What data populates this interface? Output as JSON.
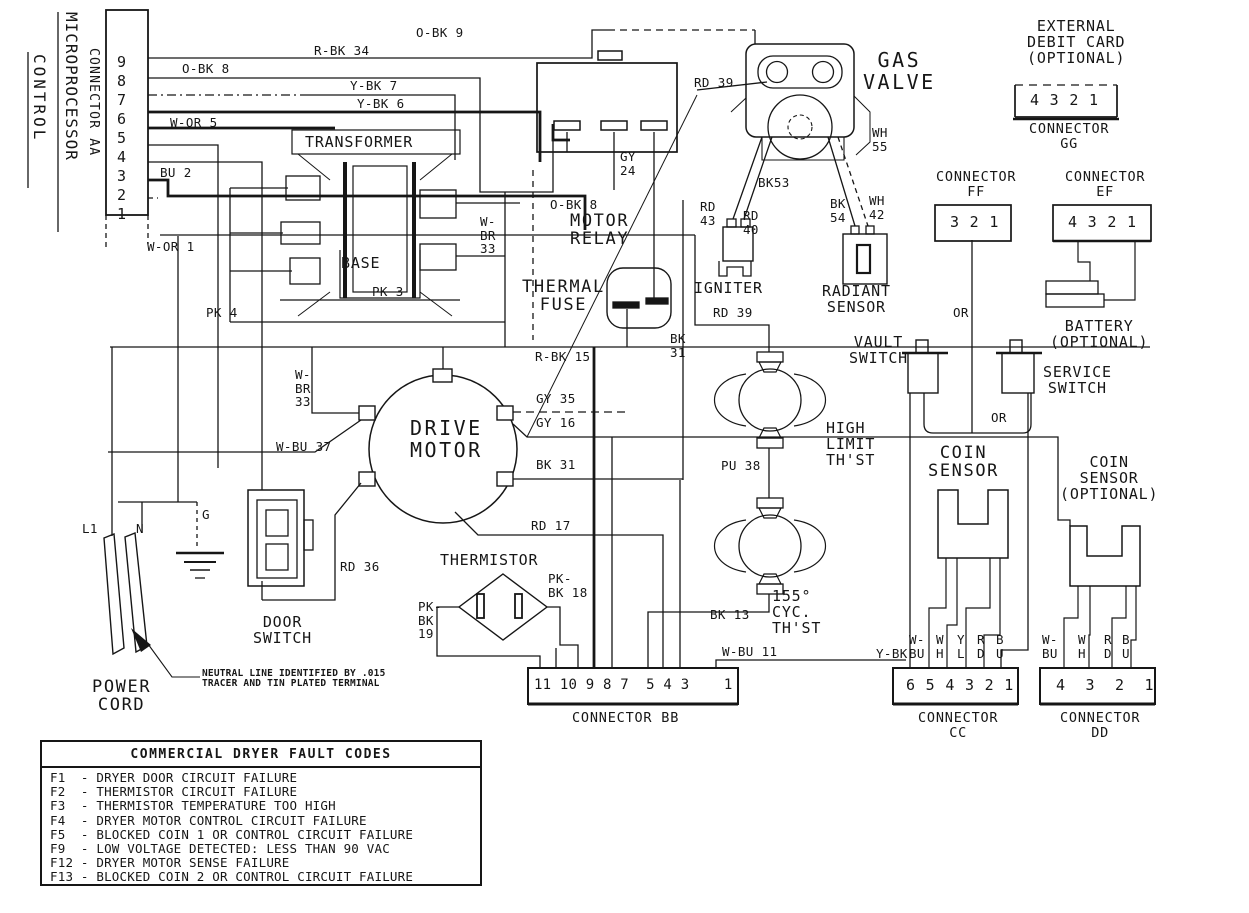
{
  "page": {
    "background": "#ffffff",
    "ink": "#161616"
  },
  "vertical_headers": {
    "microprocessor": "MICROPROCESSOR",
    "control": "CONTROL",
    "connector_aa": "CONNECTOR AA"
  },
  "note": "NEUTRAL LINE IDENTIFIED BY .015\nTRACER AND TIN PLATED TERMINAL",
  "labels": [
    {
      "n": "aa-pin-9",
      "t": "9",
      "x": 117,
      "y": 54,
      "c": "m"
    },
    {
      "n": "aa-pin-8",
      "t": "8",
      "x": 117,
      "y": 73,
      "c": "m"
    },
    {
      "n": "aa-pin-7",
      "t": "7",
      "x": 117,
      "y": 92,
      "c": "m"
    },
    {
      "n": "aa-pin-6",
      "t": "6",
      "x": 117,
      "y": 111,
      "c": "m"
    },
    {
      "n": "aa-pin-5",
      "t": "5",
      "x": 117,
      "y": 130,
      "c": "m"
    },
    {
      "n": "aa-pin-4",
      "t": "4",
      "x": 117,
      "y": 149,
      "c": "m"
    },
    {
      "n": "aa-pin-3",
      "t": "3",
      "x": 117,
      "y": 168,
      "c": "m"
    },
    {
      "n": "aa-pin-2",
      "t": "2",
      "x": 117,
      "y": 187,
      "c": "m"
    },
    {
      "n": "aa-pin-1",
      "t": "1",
      "x": 117,
      "y": 206,
      "c": "m"
    },
    {
      "n": "wire-o-bk-8-top",
      "t": "O-BK 8",
      "x": 182,
      "y": 62,
      "c": "s"
    },
    {
      "n": "wire-r-bk-34",
      "t": "R-BK 34",
      "x": 314,
      "y": 44,
      "c": "s"
    },
    {
      "n": "wire-o-bk-9",
      "t": "O-BK 9",
      "x": 416,
      "y": 26,
      "c": "s"
    },
    {
      "n": "wire-y-bk-7",
      "t": "Y-BK 7",
      "x": 350,
      "y": 79,
      "c": "s"
    },
    {
      "n": "wire-y-bk-6",
      "t": "Y-BK 6",
      "x": 357,
      "y": 97,
      "c": "s"
    },
    {
      "n": "wire-w-or-5",
      "t": "W-OR 5",
      "x": 170,
      "y": 116,
      "c": "s"
    },
    {
      "n": "wire-bu-2",
      "t": "BU 2",
      "x": 160,
      "y": 166,
      "c": "s"
    },
    {
      "n": "wire-w-or-1",
      "t": "W-OR 1",
      "x": 147,
      "y": 240,
      "c": "s"
    },
    {
      "n": "wire-pk-4",
      "t": "PK 4",
      "x": 206,
      "y": 306,
      "c": "s"
    },
    {
      "n": "wire-pk-3",
      "t": "PK 3",
      "x": 372,
      "y": 285,
      "c": "s"
    },
    {
      "n": "wire-w-br-33-upper",
      "t": "W-\nBR\n33",
      "x": 480,
      "y": 215,
      "c": "s"
    },
    {
      "n": "wire-gy-24",
      "t": "GY\n24",
      "x": 620,
      "y": 150,
      "c": "s"
    },
    {
      "n": "wire-o-bk-8-relay",
      "t": "O-BK 8",
      "x": 550,
      "y": 198,
      "c": "s"
    },
    {
      "n": "wire-rd-39-top",
      "t": "RD 39",
      "x": 694,
      "y": 76,
      "c": "s"
    },
    {
      "n": "wire-wh-55",
      "t": "WH\n55",
      "x": 872,
      "y": 126,
      "c": "s"
    },
    {
      "n": "wire-bk53",
      "t": "BK53",
      "x": 758,
      "y": 176,
      "c": "s"
    },
    {
      "n": "wire-rd-43",
      "t": "RD\n43",
      "x": 700,
      "y": 200,
      "c": "s"
    },
    {
      "n": "wire-rd-40",
      "t": "RD\n40",
      "x": 743,
      "y": 209,
      "c": "s"
    },
    {
      "n": "wire-bk-54",
      "t": "BK\n54",
      "x": 830,
      "y": 197,
      "c": "s"
    },
    {
      "n": "wire-wh-42",
      "t": "WH\n42",
      "x": 869,
      "y": 194,
      "c": "s"
    },
    {
      "n": "wire-r-bk-15",
      "t": "R-BK 15",
      "x": 535,
      "y": 350,
      "c": "s"
    },
    {
      "n": "wire-bk-31-vert",
      "t": "BK\n31",
      "x": 670,
      "y": 332,
      "c": "s"
    },
    {
      "n": "wire-rd-39-lower",
      "t": "RD 39",
      "x": 713,
      "y": 306,
      "c": "s"
    },
    {
      "n": "wire-gy-35",
      "t": "GY 35",
      "x": 536,
      "y": 392,
      "c": "s"
    },
    {
      "n": "wire-gy-16",
      "t": "GY 16",
      "x": 536,
      "y": 416,
      "c": "s"
    },
    {
      "n": "wire-bk-31-horiz",
      "t": "BK 31",
      "x": 536,
      "y": 458,
      "c": "s"
    },
    {
      "n": "wire-rd-17",
      "t": "RD 17",
      "x": 531,
      "y": 519,
      "c": "s"
    },
    {
      "n": "wire-rd-36",
      "t": "RD 36",
      "x": 340,
      "y": 560,
      "c": "s"
    },
    {
      "n": "wire-w-br-33-motor",
      "t": "W-\nBR\n33",
      "x": 295,
      "y": 368,
      "c": "s"
    },
    {
      "n": "wire-w-bu-37",
      "t": "W-BU 37",
      "x": 276,
      "y": 440,
      "c": "s"
    },
    {
      "n": "wire-pu-38",
      "t": "PU 38",
      "x": 721,
      "y": 459,
      "c": "s"
    },
    {
      "n": "wire-bk-13",
      "t": "BK 13",
      "x": 710,
      "y": 608,
      "c": "s"
    },
    {
      "n": "wire-w-bu-11",
      "t": "W-BU 11",
      "x": 722,
      "y": 645,
      "c": "s"
    },
    {
      "n": "wire-pk-bk-18",
      "t": "PK-\nBK 18",
      "x": 548,
      "y": 572,
      "c": "s"
    },
    {
      "n": "wire-pk-bk-19",
      "t": "PK-\nBK\n19",
      "x": 418,
      "y": 600,
      "c": "s"
    },
    {
      "n": "wire-or-ff",
      "t": "OR",
      "x": 953,
      "y": 306,
      "c": "s"
    },
    {
      "n": "wire-or-switch",
      "t": "OR",
      "x": 991,
      "y": 411,
      "c": "s"
    },
    {
      "n": "wire-y-bk-cc",
      "t": "Y-BK",
      "x": 876,
      "y": 647,
      "c": "s"
    },
    {
      "n": "wire-cc-w-bu",
      "t": "W-\nBU",
      "x": 909,
      "y": 633,
      "c": "s"
    },
    {
      "n": "wire-cc-wh",
      "t": "W\nH",
      "x": 936,
      "y": 633,
      "c": "s"
    },
    {
      "n": "wire-cc-yl",
      "t": "Y\nL",
      "x": 957,
      "y": 633,
      "c": "s"
    },
    {
      "n": "wire-cc-rd",
      "t": "R\nD",
      "x": 977,
      "y": 633,
      "c": "s"
    },
    {
      "n": "wire-cc-bu",
      "t": "B\nU",
      "x": 996,
      "y": 633,
      "c": "s"
    },
    {
      "n": "wire-dd-w-bu",
      "t": "W-\nBU",
      "x": 1042,
      "y": 633,
      "c": "s"
    },
    {
      "n": "wire-dd-wh",
      "t": "W\nH",
      "x": 1078,
      "y": 633,
      "c": "s"
    },
    {
      "n": "wire-dd-rd",
      "t": "R\nD",
      "x": 1104,
      "y": 633,
      "c": "s"
    },
    {
      "n": "wire-dd-bu",
      "t": "B\nU",
      "x": 1122,
      "y": 633,
      "c": "s"
    },
    {
      "n": "power-l1",
      "t": "L1",
      "x": 82,
      "y": 522,
      "c": "s"
    },
    {
      "n": "power-n",
      "t": "N",
      "x": 136,
      "y": 522,
      "c": "s"
    },
    {
      "n": "power-g",
      "t": "G",
      "x": 202,
      "y": 508,
      "c": "s"
    },
    {
      "n": "label-transformer",
      "t": "TRANSFORMER",
      "x": 305,
      "y": 134,
      "c": "m"
    },
    {
      "n": "label-base",
      "t": "BASE",
      "x": 341,
      "y": 255,
      "c": "m"
    },
    {
      "n": "label-motor-relay",
      "t": "MOTOR\nRELAY",
      "x": 570,
      "y": 212,
      "c": "l c"
    },
    {
      "n": "label-thermal-fuse",
      "t": "THERMAL\nFUSE",
      "x": 522,
      "y": 278,
      "c": "l c"
    },
    {
      "n": "label-gas-valve",
      "t": "GAS\nVALVE",
      "x": 863,
      "y": 50,
      "c": "xl c"
    },
    {
      "n": "label-igniter",
      "t": "IGNITER",
      "x": 694,
      "y": 280,
      "c": "m"
    },
    {
      "n": "label-radiant-sensor",
      "t": "RADIANT\nSENSOR",
      "x": 822,
      "y": 283,
      "c": "m c"
    },
    {
      "n": "label-vault-switch",
      "t": "VAULT\nSWITCH",
      "x": 849,
      "y": 334,
      "c": "m c"
    },
    {
      "n": "label-service-switch",
      "t": "SERVICE\nSWITCH",
      "x": 1043,
      "y": 364,
      "c": "m c"
    },
    {
      "n": "label-coin-sensor",
      "t": "COIN\nSENSOR",
      "x": 928,
      "y": 444,
      "c": "l c"
    },
    {
      "n": "label-coin-sensor-opt",
      "t": "COIN\nSENSOR\n(OPTIONAL)",
      "x": 1060,
      "y": 454,
      "c": "m c"
    },
    {
      "n": "label-high-limit",
      "t": "HIGH\nLIMIT\nTH'ST",
      "x": 826,
      "y": 420,
      "c": "m"
    },
    {
      "n": "label-cyc-thst",
      "t": "155°\nCYC.\nTH'ST",
      "x": 772,
      "y": 588,
      "c": "m"
    },
    {
      "n": "label-drive-motor",
      "t": "DRIVE\nMOTOR",
      "x": 410,
      "y": 418,
      "c": "xl c"
    },
    {
      "n": "label-thermistor",
      "t": "THERMISTOR",
      "x": 440,
      "y": 552,
      "c": "m"
    },
    {
      "n": "label-door-switch",
      "t": "DOOR\nSWITCH",
      "x": 253,
      "y": 614,
      "c": "m c"
    },
    {
      "n": "label-power-cord",
      "t": "POWER\nCORD",
      "x": 92,
      "y": 678,
      "c": "l c"
    },
    {
      "n": "label-external-debit",
      "t": "EXTERNAL\nDEBIT CARD\n(OPTIONAL)",
      "x": 1027,
      "y": 18,
      "c": "m c"
    },
    {
      "n": "label-battery",
      "t": "BATTERY\n(OPTIONAL)",
      "x": 1050,
      "y": 318,
      "c": "m c"
    },
    {
      "n": "label-connector-gg",
      "t": "CONNECTOR\nGG",
      "x": 1029,
      "y": 122,
      "c": "mc c"
    },
    {
      "n": "label-connector-ff",
      "t": "CONNECTOR\nFF",
      "x": 936,
      "y": 170,
      "c": "mc c"
    },
    {
      "n": "label-connector-ef",
      "t": "CONNECTOR\nEF",
      "x": 1065,
      "y": 170,
      "c": "mc c"
    },
    {
      "n": "label-connector-bb",
      "t": "CONNECTOR BB",
      "x": 572,
      "y": 711,
      "c": "mc"
    },
    {
      "n": "label-connector-cc",
      "t": "CONNECTOR\nCC",
      "x": 918,
      "y": 711,
      "c": "mc c"
    },
    {
      "n": "label-connector-dd",
      "t": "CONNECTOR\nDD",
      "x": 1060,
      "y": 711,
      "c": "mc c"
    },
    {
      "n": "connector-gg-pins",
      "t": "4 3 2 1",
      "x": 1030,
      "y": 92,
      "c": "m"
    },
    {
      "n": "connector-ff-pins",
      "t": "3 2 1",
      "x": 950,
      "y": 214,
      "c": "m"
    },
    {
      "n": "connector-ef-pins",
      "t": "4 3 2 1",
      "x": 1068,
      "y": 214,
      "c": "m"
    },
    {
      "n": "connector-bb-pins",
      "t": "11 10 9 8 7  5 4 3    1",
      "x": 534,
      "y": 678,
      "c": "m3"
    },
    {
      "n": "connector-cc-pins",
      "t": "6 5 4 3 2 1",
      "x": 906,
      "y": 677,
      "c": "m"
    },
    {
      "n": "connector-dd-pins",
      "t": "4  3  2  1",
      "x": 1056,
      "y": 677,
      "c": "m"
    }
  ],
  "fault_codes": {
    "title": "COMMERCIAL DRYER FAULT CODES",
    "rows": [
      {
        "code": "F1",
        "desc": "DRYER DOOR CIRCUIT FAILURE"
      },
      {
        "code": "F2",
        "desc": "THERMISTOR CIRCUIT FAILURE"
      },
      {
        "code": "F3",
        "desc": "THERMISTOR TEMPERATURE TOO HIGH"
      },
      {
        "code": "F4",
        "desc": "DRYER MOTOR CONTROL CIRCUIT FAILURE"
      },
      {
        "code": "F5",
        "desc": "BLOCKED COIN 1 OR CONTROL CIRCUIT FAILURE"
      },
      {
        "code": "F9",
        "desc": "LOW VOLTAGE DETECTED: LESS THAN 90 VAC"
      },
      {
        "code": "F12",
        "desc": "DRYER MOTOR SENSE FAILURE"
      },
      {
        "code": "F13",
        "desc": "BLOCKED COIN 2 OR CONTROL CIRCUIT FAILURE"
      }
    ]
  }
}
